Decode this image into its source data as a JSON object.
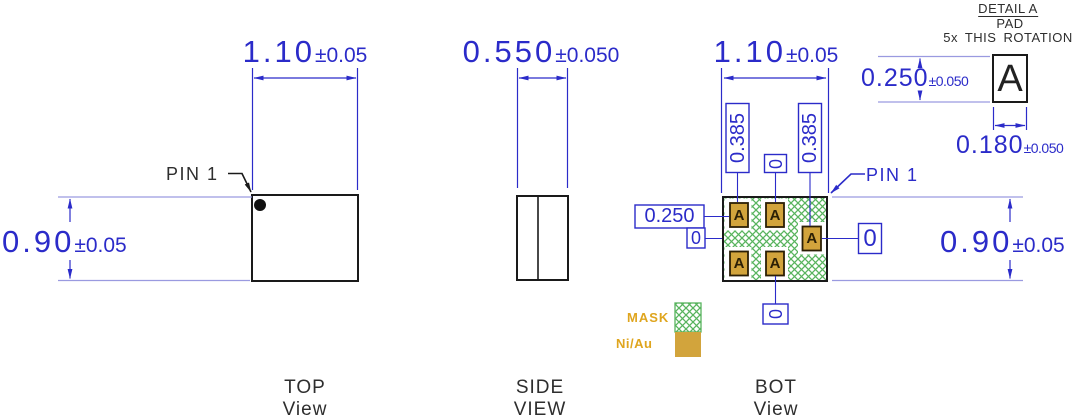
{
  "colors": {
    "dimension_blue": "#2b2bc9",
    "extension_light_blue": "#9a9ae0",
    "line_black": "#1a1a1a",
    "label_gray": "#2e2e2e",
    "pad_gold": "#d2a43c",
    "legend_gold_text": "#dfa51e",
    "mask_green": "#58b45e"
  },
  "top_view": {
    "width_dim": {
      "value": "1.10",
      "tolerance": "±0.05"
    },
    "height_dim": {
      "value": "0.90",
      "tolerance": "±0.05"
    },
    "pin1_label": "PIN 1",
    "title": "TOP",
    "subtitle": "View"
  },
  "side_view": {
    "width_dim": {
      "value": "0.550",
      "tolerance": "±0.050"
    },
    "title": "SIDE",
    "subtitle": "VIEW"
  },
  "bot_view": {
    "width_dim": {
      "value": "1.10",
      "tolerance": "±0.05"
    },
    "height_dim": {
      "value": "0.90",
      "tolerance": "±0.05"
    },
    "pin1_label": "PIN 1",
    "col1_dim": "0.385",
    "col2_dim": "0",
    "col3_dim": "0.385",
    "pad_offset_dim": "0.250",
    "left_zero": "0",
    "right_zero": "0",
    "bottom_zero": "0",
    "pad_letter": "A",
    "legend": {
      "mask": "MASK",
      "finish": "Ni/Au"
    },
    "title": "BOT",
    "subtitle": "View"
  },
  "detail": {
    "title": "DETAIL A",
    "subtitle": "PAD",
    "note": "5x THIS ROTATION",
    "pad_letter": "A",
    "height_dim": {
      "value": "0.250",
      "tolerance": "±0.050"
    },
    "width_dim": {
      "value": "0.180",
      "tolerance": "±0.050"
    }
  }
}
